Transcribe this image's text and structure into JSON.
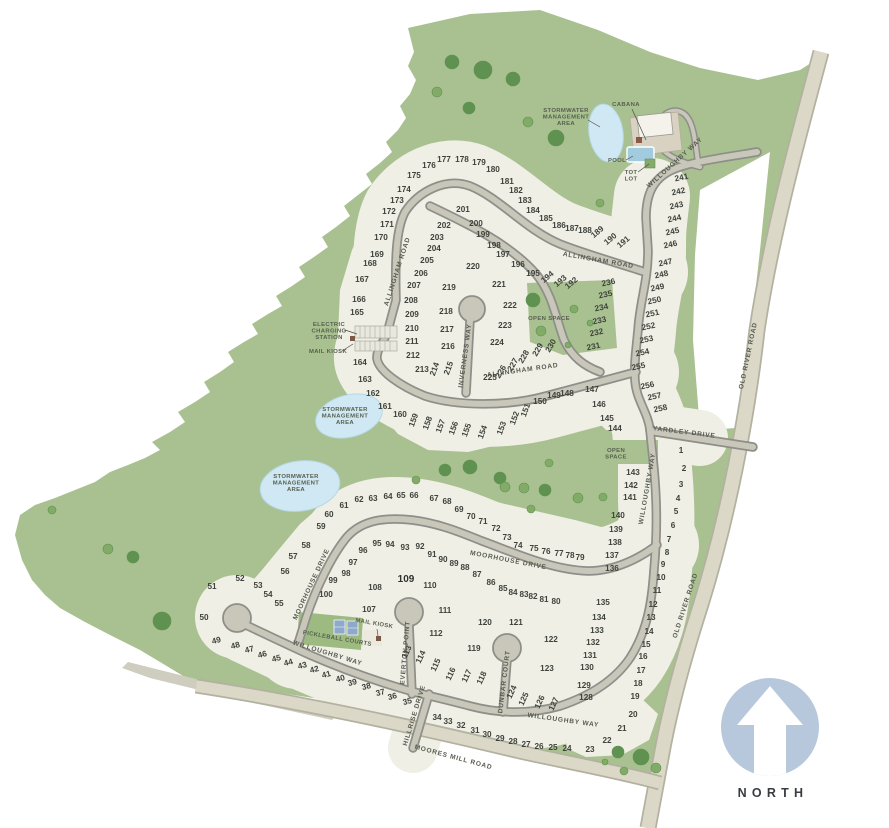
{
  "north": {
    "label": "NORTH"
  },
  "colors": {
    "green": "#a9c190",
    "tree": "#5f9150",
    "tree_light": "#83ab68",
    "cream": "#f0efe6",
    "road_fill": "#c9c7ba",
    "road_casing": "#8f8f8a",
    "beige_fill": "#dbd8c8",
    "beige_casing": "#b3b1a0",
    "pond": "#cfe8f3",
    "pond_edge": "#b5d8e8",
    "north_circle": "#b7c8dd",
    "pool": "#a3cbe0",
    "court": "#8fa9cc",
    "kiosk": "#7b5a45",
    "label_text": "#57604f",
    "lot_text": "#3d423b"
  },
  "street_labels": [
    {
      "label": "WILLOUGHBY WAY",
      "x": 676,
      "y": 164,
      "rot": -42
    },
    {
      "label": "ALLINGHAM ROAD",
      "x": 598,
      "y": 262,
      "rot": 10
    },
    {
      "label": "ALLINGHAM ROAD",
      "x": 399,
      "y": 272,
      "rot": -72
    },
    {
      "label": "ALLINGHAM ROAD",
      "x": 523,
      "y": 372,
      "rot": -8
    },
    {
      "label": "INVERNESS WAY",
      "x": 467,
      "y": 356,
      "rot": -82
    },
    {
      "label": "WILLOUGHBY WAY",
      "x": 649,
      "y": 489,
      "rot": -80
    },
    {
      "label": "YARDLEY DRIVE",
      "x": 684,
      "y": 434,
      "rot": 7
    },
    {
      "label": "OLD RIVER ROAD",
      "x": 750,
      "y": 356,
      "rot": -78
    },
    {
      "label": "OLD RIVER ROAD",
      "x": 687,
      "y": 606,
      "rot": -72
    },
    {
      "label": "MOORHOUSE DRIVE",
      "x": 508,
      "y": 562,
      "rot": 11
    },
    {
      "label": "MOORHOUSE DRIVE",
      "x": 313,
      "y": 585,
      "rot": -65
    },
    {
      "label": "WILLOUGHBY WAY",
      "x": 327,
      "y": 655,
      "rot": 17
    },
    {
      "label": "WILLOUGHBY WAY",
      "x": 563,
      "y": 722,
      "rot": 8
    },
    {
      "label": "EVERTON POINT",
      "x": 407,
      "y": 653,
      "rot": -85
    },
    {
      "label": "DUNBAR COURT",
      "x": 506,
      "y": 682,
      "rot": -83
    },
    {
      "label": "HILLRISE DRIVE",
      "x": 416,
      "y": 716,
      "rot": -73
    },
    {
      "label": "MOORES MILL ROAD",
      "x": 453,
      "y": 759,
      "rot": 15
    }
  ],
  "area_labels": [
    {
      "lines": [
        "STORMWATER",
        "MANAGEMENT",
        "AREA"
      ],
      "x": 566,
      "y": 112,
      "rot": 0
    },
    {
      "lines": [
        "STORMWATER",
        "MANAGEMENT",
        "AREA"
      ],
      "x": 345,
      "y": 411,
      "rot": 0
    },
    {
      "lines": [
        "STORMWATER",
        "MANAGEMENT",
        "AREA"
      ],
      "x": 296,
      "y": 478,
      "rot": 0
    },
    {
      "lines": [
        "OPEN SPACE"
      ],
      "x": 549,
      "y": 320,
      "rot": 0
    },
    {
      "lines": [
        "OPEN",
        "SPACE"
      ],
      "x": 616,
      "y": 452,
      "rot": 0
    },
    {
      "lines": [
        "ELECTRIC",
        "CHARGING",
        "STATION"
      ],
      "x": 329,
      "y": 326,
      "rot": 0
    },
    {
      "lines": [
        "MAIL KIOSK"
      ],
      "x": 328,
      "y": 353,
      "rot": 0
    },
    {
      "lines": [
        "CABANA"
      ],
      "x": 626,
      "y": 106,
      "rot": 0
    },
    {
      "lines": [
        "POOL"
      ],
      "x": 617,
      "y": 162,
      "rot": 0
    },
    {
      "lines": [
        "TOT",
        "LOT"
      ],
      "x": 631,
      "y": 174,
      "rot": 0
    },
    {
      "lines": [
        "MAIL KIOSK"
      ],
      "x": 374,
      "y": 625,
      "rot": 10
    },
    {
      "lines": [
        "PICKLEBALL COURTS"
      ],
      "x": 337,
      "y": 640,
      "rot": 10
    }
  ],
  "lots": [
    [
      1,
      681,
      453
    ],
    [
      2,
      684,
      471
    ],
    [
      3,
      681,
      487
    ],
    [
      4,
      678,
      501
    ],
    [
      5,
      676,
      514
    ],
    [
      6,
      673,
      528
    ],
    [
      7,
      669,
      542
    ],
    [
      8,
      667,
      555
    ],
    [
      9,
      663,
      567
    ],
    [
      10,
      661,
      580
    ],
    [
      11,
      657,
      593
    ],
    [
      12,
      653,
      607
    ],
    [
      13,
      651,
      620
    ],
    [
      14,
      649,
      634
    ],
    [
      15,
      646,
      647
    ],
    [
      16,
      643,
      659
    ],
    [
      17,
      641,
      673
    ],
    [
      18,
      638,
      686
    ],
    [
      19,
      635,
      699
    ],
    [
      20,
      633,
      717
    ],
    [
      21,
      622,
      731
    ],
    [
      22,
      607,
      743
    ],
    [
      23,
      590,
      752
    ],
    [
      24,
      567,
      751
    ],
    [
      25,
      553,
      750
    ],
    [
      26,
      539,
      749
    ],
    [
      27,
      526,
      747
    ],
    [
      28,
      513,
      744
    ],
    [
      29,
      500,
      741
    ],
    [
      30,
      487,
      737
    ],
    [
      31,
      475,
      733
    ],
    [
      32,
      461,
      728
    ],
    [
      33,
      448,
      724
    ],
    [
      34,
      437,
      720
    ],
    [
      35,
      408,
      704,
      -15
    ],
    [
      36,
      393,
      699,
      -15
    ],
    [
      37,
      381,
      695,
      -15
    ],
    [
      38,
      367,
      689,
      -15
    ],
    [
      39,
      353,
      685,
      -15
    ],
    [
      40,
      341,
      681,
      -15
    ],
    [
      41,
      327,
      677,
      -15
    ],
    [
      42,
      315,
      672,
      -15
    ],
    [
      43,
      303,
      668,
      -15
    ],
    [
      44,
      289,
      665,
      -15
    ],
    [
      45,
      277,
      661,
      -15
    ],
    [
      46,
      263,
      657,
      -15
    ],
    [
      47,
      250,
      652,
      -15
    ],
    [
      48,
      236,
      648,
      -15
    ],
    [
      49,
      217,
      643,
      -15
    ],
    [
      50,
      204,
      620
    ],
    [
      51,
      212,
      589
    ],
    [
      52,
      240,
      581
    ],
    [
      53,
      258,
      588
    ],
    [
      54,
      268,
      597
    ],
    [
      55,
      279,
      606
    ],
    [
      56,
      285,
      574
    ],
    [
      57,
      293,
      559
    ],
    [
      58,
      306,
      548
    ],
    [
      59,
      321,
      529
    ],
    [
      60,
      329,
      517
    ],
    [
      61,
      344,
      508
    ],
    [
      62,
      359,
      502
    ],
    [
      63,
      373,
      501
    ],
    [
      64,
      388,
      499
    ],
    [
      65,
      401,
      498
    ],
    [
      66,
      414,
      498
    ],
    [
      67,
      434,
      501
    ],
    [
      68,
      447,
      504
    ],
    [
      69,
      459,
      512
    ],
    [
      70,
      471,
      519
    ],
    [
      71,
      483,
      524
    ],
    [
      72,
      496,
      531
    ],
    [
      73,
      507,
      540
    ],
    [
      74,
      518,
      548
    ],
    [
      75,
      534,
      551
    ],
    [
      76,
      546,
      554
    ],
    [
      77,
      559,
      556
    ],
    [
      78,
      570,
      558
    ],
    [
      79,
      580,
      560
    ],
    [
      80,
      556,
      604
    ],
    [
      81,
      544,
      602
    ],
    [
      82,
      533,
      599
    ],
    [
      83,
      524,
      597
    ],
    [
      84,
      513,
      595
    ],
    [
      85,
      503,
      591
    ],
    [
      86,
      491,
      585
    ],
    [
      87,
      477,
      577
    ],
    [
      88,
      465,
      570
    ],
    [
      89,
      454,
      566
    ],
    [
      90,
      443,
      562
    ],
    [
      91,
      432,
      557
    ],
    [
      92,
      420,
      549
    ],
    [
      93,
      405,
      550
    ],
    [
      94,
      390,
      547
    ],
    [
      95,
      377,
      546
    ],
    [
      96,
      363,
      553
    ],
    [
      97,
      353,
      565
    ],
    [
      98,
      346,
      576
    ],
    [
      99,
      333,
      583
    ],
    [
      100,
      326,
      597
    ],
    [
      107,
      369,
      612
    ],
    [
      108,
      375,
      590
    ],
    [
      109,
      406,
      582
    ],
    [
      110,
      430,
      588
    ],
    [
      111,
      445,
      613
    ],
    [
      112,
      436,
      636
    ],
    [
      113,
      409,
      653,
      -65
    ],
    [
      114,
      423,
      658,
      -65
    ],
    [
      115,
      438,
      666,
      -65
    ],
    [
      116,
      453,
      675,
      -65
    ],
    [
      117,
      469,
      677,
      -65
    ],
    [
      118,
      484,
      679,
      -65
    ],
    [
      119,
      474,
      651
    ],
    [
      120,
      485,
      625
    ],
    [
      121,
      516,
      625
    ],
    [
      122,
      551,
      642
    ],
    [
      123,
      547,
      671
    ],
    [
      124,
      514,
      693,
      -65
    ],
    [
      125,
      526,
      700,
      -65
    ],
    [
      126,
      542,
      703,
      -65
    ],
    [
      127,
      556,
      705,
      -65
    ],
    [
      128,
      586,
      700
    ],
    [
      129,
      584,
      688
    ],
    [
      130,
      587,
      670
    ],
    [
      131,
      590,
      658
    ],
    [
      132,
      593,
      645
    ],
    [
      133,
      597,
      633
    ],
    [
      134,
      599,
      620
    ],
    [
      135,
      603,
      605
    ],
    [
      136,
      612,
      571
    ],
    [
      137,
      612,
      558
    ],
    [
      138,
      615,
      545
    ],
    [
      139,
      616,
      532
    ],
    [
      140,
      618,
      518
    ],
    [
      141,
      630,
      500
    ],
    [
      142,
      631,
      488
    ],
    [
      143,
      633,
      475
    ],
    [
      144,
      615,
      431
    ],
    [
      145,
      607,
      421
    ],
    [
      146,
      599,
      407
    ],
    [
      147,
      592,
      392
    ],
    [
      148,
      567,
      396
    ],
    [
      149,
      554,
      398
    ],
    [
      150,
      540,
      404
    ],
    [
      151,
      528,
      411,
      -70
    ],
    [
      152,
      517,
      419,
      -70
    ],
    [
      153,
      504,
      429,
      -70
    ],
    [
      154,
      485,
      433,
      -70
    ],
    [
      155,
      469,
      431,
      -70
    ],
    [
      156,
      456,
      429,
      -70
    ],
    [
      157,
      443,
      427,
      -70
    ],
    [
      158,
      430,
      424,
      -70
    ],
    [
      159,
      416,
      421,
      -70
    ],
    [
      160,
      400,
      417
    ],
    [
      161,
      385,
      409
    ],
    [
      162,
      373,
      396
    ],
    [
      163,
      365,
      382
    ],
    [
      164,
      360,
      365
    ],
    [
      165,
      357,
      315
    ],
    [
      166,
      359,
      302
    ],
    [
      167,
      362,
      282
    ],
    [
      168,
      370,
      266
    ],
    [
      169,
      377,
      257
    ],
    [
      170,
      381,
      240
    ],
    [
      171,
      387,
      227
    ],
    [
      172,
      389,
      214
    ],
    [
      173,
      397,
      203
    ],
    [
      174,
      404,
      192
    ],
    [
      175,
      414,
      178
    ],
    [
      176,
      429,
      168
    ],
    [
      177,
      444,
      162
    ],
    [
      178,
      462,
      162
    ],
    [
      179,
      479,
      165
    ],
    [
      180,
      493,
      172
    ],
    [
      181,
      507,
      184
    ],
    [
      182,
      516,
      193
    ],
    [
      183,
      525,
      203
    ],
    [
      184,
      533,
      213
    ],
    [
      185,
      546,
      221
    ],
    [
      186,
      559,
      228
    ],
    [
      187,
      572,
      231
    ],
    [
      188,
      585,
      233
    ],
    [
      189,
      599,
      234,
      -40
    ],
    [
      190,
      612,
      241,
      -40
    ],
    [
      191,
      625,
      244,
      -40
    ],
    [
      192,
      573,
      285,
      -40
    ],
    [
      193,
      562,
      283,
      -40
    ],
    [
      194,
      549,
      279,
      -40
    ],
    [
      195,
      533,
      276
    ],
    [
      196,
      518,
      267
    ],
    [
      197,
      503,
      257
    ],
    [
      198,
      494,
      248
    ],
    [
      199,
      483,
      237
    ],
    [
      200,
      476,
      226
    ],
    [
      201,
      463,
      212
    ],
    [
      202,
      444,
      228
    ],
    [
      203,
      437,
      240
    ],
    [
      204,
      434,
      251
    ],
    [
      205,
      427,
      263
    ],
    [
      206,
      421,
      276
    ],
    [
      207,
      414,
      288
    ],
    [
      208,
      411,
      303
    ],
    [
      209,
      412,
      317
    ],
    [
      210,
      412,
      331
    ],
    [
      211,
      412,
      344
    ],
    [
      212,
      413,
      358
    ],
    [
      213,
      422,
      372
    ],
    [
      214,
      437,
      370,
      -70
    ],
    [
      215,
      451,
      369,
      -70
    ],
    [
      216,
      448,
      349
    ],
    [
      217,
      447,
      332
    ],
    [
      218,
      446,
      314
    ],
    [
      219,
      449,
      290
    ],
    [
      220,
      473,
      269
    ],
    [
      221,
      499,
      287
    ],
    [
      222,
      510,
      308
    ],
    [
      223,
      505,
      328
    ],
    [
      224,
      497,
      345
    ],
    [
      225,
      490,
      380
    ],
    [
      226,
      503,
      373,
      -60
    ],
    [
      227,
      515,
      366,
      -60
    ],
    [
      228,
      526,
      358,
      -60
    ],
    [
      229,
      540,
      351,
      -60
    ],
    [
      230,
      553,
      347,
      -60
    ],
    [
      231,
      594,
      349,
      -12
    ],
    [
      232,
      597,
      335,
      -12
    ],
    [
      233,
      600,
      323,
      -12
    ],
    [
      234,
      602,
      310,
      -12
    ],
    [
      235,
      606,
      297,
      -12
    ],
    [
      236,
      609,
      285,
      -12
    ],
    [
      241,
      682,
      180,
      -12
    ],
    [
      242,
      679,
      194,
      -12
    ],
    [
      243,
      677,
      208,
      -12
    ],
    [
      244,
      675,
      221,
      -12
    ],
    [
      245,
      673,
      234,
      -12
    ],
    [
      246,
      671,
      247,
      -12
    ],
    [
      247,
      666,
      265,
      -12
    ],
    [
      248,
      662,
      277,
      -12
    ],
    [
      249,
      658,
      290,
      -12
    ],
    [
      250,
      655,
      303,
      -12
    ],
    [
      251,
      653,
      316,
      -12
    ],
    [
      252,
      649,
      329,
      -12
    ],
    [
      253,
      647,
      342,
      -12
    ],
    [
      254,
      643,
      355,
      -12
    ],
    [
      255,
      639,
      369,
      -12
    ],
    [
      256,
      648,
      388,
      -12
    ],
    [
      257,
      655,
      399,
      -12
    ],
    [
      258,
      661,
      411,
      -12
    ]
  ],
  "trees": [
    [
      452,
      62,
      7
    ],
    [
      483,
      70,
      9
    ],
    [
      513,
      79,
      7
    ],
    [
      469,
      108,
      6
    ],
    [
      437,
      92,
      5
    ],
    [
      528,
      122,
      5
    ],
    [
      556,
      138,
      8
    ],
    [
      600,
      203,
      4
    ],
    [
      603,
      497,
      4
    ],
    [
      533,
      300,
      7
    ],
    [
      574,
      309,
      4
    ],
    [
      541,
      331,
      5
    ],
    [
      568,
      345,
      3
    ],
    [
      590,
      323,
      3
    ],
    [
      445,
      470,
      6
    ],
    [
      470,
      467,
      7
    ],
    [
      500,
      478,
      6
    ],
    [
      524,
      488,
      5
    ],
    [
      549,
      463,
      4
    ],
    [
      416,
      480,
      4
    ],
    [
      505,
      487,
      5
    ],
    [
      545,
      490,
      6
    ],
    [
      578,
      498,
      5
    ],
    [
      531,
      509,
      4
    ],
    [
      108,
      549,
      5
    ],
    [
      133,
      557,
      6
    ],
    [
      162,
      621,
      9
    ],
    [
      52,
      510,
      4
    ],
    [
      618,
      752,
      6
    ],
    [
      641,
      757,
      8
    ],
    [
      656,
      768,
      5
    ],
    [
      624,
      771,
      4
    ],
    [
      605,
      762,
      3
    ]
  ]
}
